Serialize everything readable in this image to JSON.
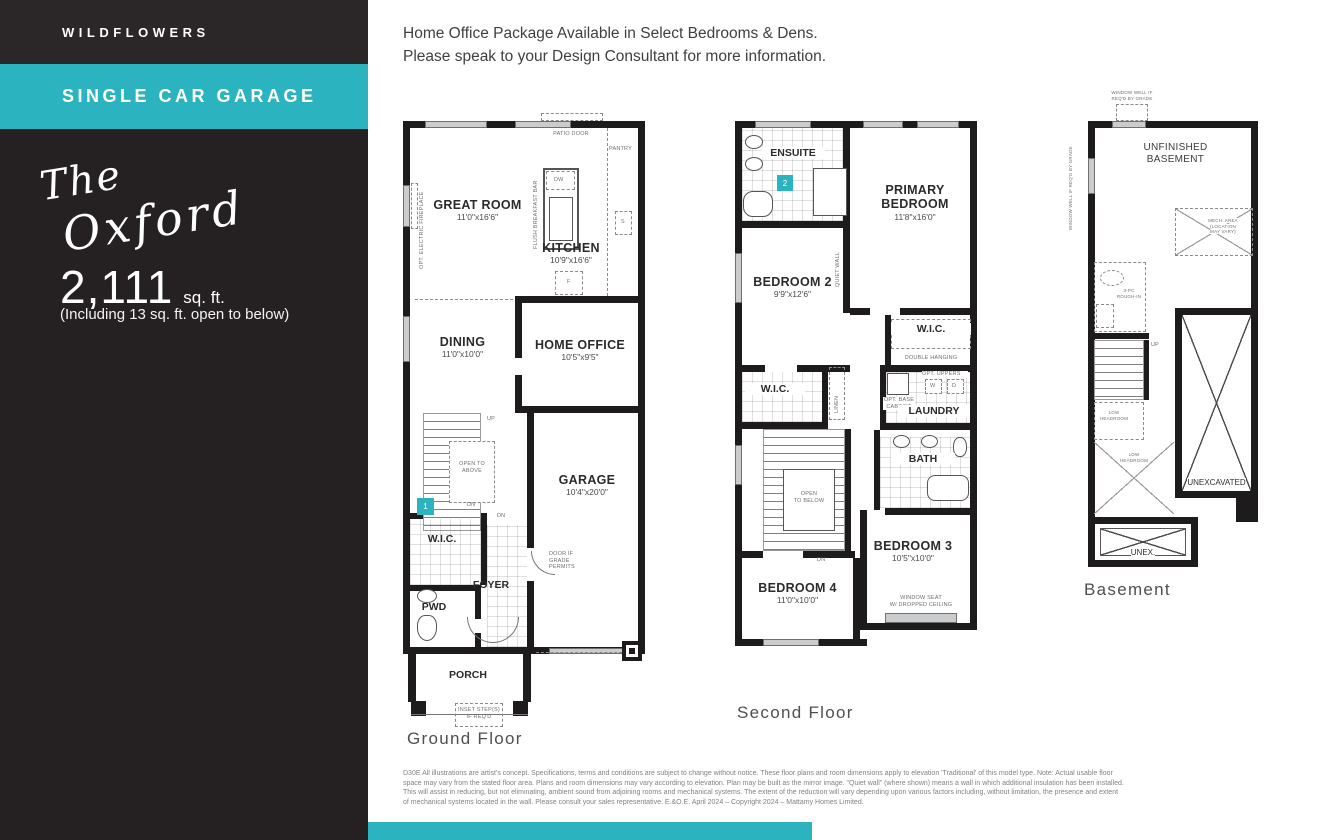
{
  "palette": {
    "dark": "#252122",
    "teal": "#2bb3bf"
  },
  "sidebar": {
    "community": "WILDFLOWERS",
    "banner": "SINGLE CAR GARAGE",
    "model_the": "The",
    "model_name": "Oxford",
    "sqft": "2,111",
    "sqft_unit": "sq. ft.",
    "sqft_note": "(Including 13 sq. ft. open to below)"
  },
  "intro": {
    "line1": "Home Office Package Available in Select Bedrooms & Dens.",
    "line2": "Please speak to your Design Consultant for more information."
  },
  "ground": {
    "label": "Ground Floor",
    "rooms": {
      "great_room": {
        "name": "GREAT ROOM",
        "dims": "11'0\"x16'6\""
      },
      "kitchen": {
        "name": "KITCHEN",
        "dims": "10'9\"x16'6\""
      },
      "dining": {
        "name": "DINING",
        "dims": "11'0\"x10'0\""
      },
      "home_office": {
        "name": "HOME OFFICE",
        "dims": "10'5\"x9'5\""
      },
      "garage": {
        "name": "GARAGE",
        "dims": "10'4\"x20'0\""
      },
      "wic": "W.I.C.",
      "pwd": "PWD",
      "foyer": "FOYER",
      "porch": "PORCH"
    },
    "notes": {
      "patio_door": "PATIO DOOR",
      "pantry": "PANTRY",
      "dw": "DW",
      "sink": "S",
      "fridge": "F",
      "flush_bar": "FLUSH BREAKFAST BAR",
      "fireplace": "OPT. ELECTRIC FIREPLACE",
      "up": "UP",
      "dn1": "DN",
      "dn2": "DN",
      "open_to_above": "OPEN TO ABOVE",
      "door_grade": "DOOR IF GRADE PERMITS",
      "inset_steps1": "INSET STEP(S)",
      "inset_steps2": "IF REQ'D",
      "marker": "1"
    }
  },
  "second": {
    "label": "Second Floor",
    "rooms": {
      "primary_line1": "PRIMARY",
      "primary_line2": "BEDROOM",
      "primary_dims": "11'8\"x16'0\"",
      "bedroom2": {
        "name": "BEDROOM 2",
        "dims": "9'9\"x12'6\""
      },
      "bedroom3": {
        "name": "BEDROOM 3",
        "dims": "10'5\"x10'0\""
      },
      "bedroom4": {
        "name": "BEDROOM 4",
        "dims": "11'0\"x10'0\""
      },
      "ensuite": "ENSUITE",
      "bath": "BATH",
      "laundry": "LAUNDRY",
      "wic_left": "W.I.C.",
      "wic_right": "W.I.C."
    },
    "notes": {
      "double_hanging": "DOUBLE HANGING",
      "opt_uppers": "OPT. UPPERS",
      "opt_base1": "OPT. BASE",
      "opt_base2": "CABINET",
      "washer": "W",
      "dryer": "D",
      "linen": "LINEN",
      "quiet_wall": "QUIET WALL",
      "open_to_below1": "OPEN",
      "open_to_below2": "TO BELOW",
      "dn": "DN",
      "window_seat1": "WINDOW SEAT",
      "window_seat2": "W/ DROPPED CEILING",
      "marker": "2"
    }
  },
  "basement": {
    "label": "Basement",
    "rooms": {
      "unfinished1": "UNFINISHED",
      "unfinished2": "BASEMENT",
      "unexcavated": "UNEXCAVATED",
      "unex": "UNEX."
    },
    "notes": {
      "window_well_top1": "WINDOW WELL IF",
      "window_well_top2": "REQ'D BY GRADE",
      "window_well_left": "WINDOW WELL IF REQ'D BY GRADE",
      "mech1": "MECH. AREA",
      "mech2": "(LOCATION",
      "mech3": "MAY VARY)",
      "rough_in1": "3-PC",
      "rough_in2": "ROUGH-IN",
      "up": "UP",
      "low_headroom1": "LOW",
      "low_headroom2": "HEADROOM",
      "low_headroom3": "LOW",
      "low_headroom4": "HEADROOM"
    }
  },
  "disclaimer": {
    "line1": "D30E All illustrations are artist's concept. Specifications, terms and conditions are subject to change without notice. These floor plans and room dimensions apply to elevation 'Traditional' of this model type. Note: Actual usable floor",
    "line2": "space may vary from the stated floor area. Plans and room dimensions may vary according to elevation. Plan may be built as the mirror image. \"Quiet wall\" (where shown) means a wall in which additional insulation has been installed.",
    "line3": "This will assist in reducing, but not eliminating, ambient sound from adjoining rooms and mechanical systems. The extent of the reduction will vary depending upon various factors including, without limitation, the presence and extent",
    "line4": "of mechanical systems located in the wall. Please consult your sales representative. E.&O.E. April 2024 – Copyright 2024 – Mattamy Homes Limited."
  }
}
